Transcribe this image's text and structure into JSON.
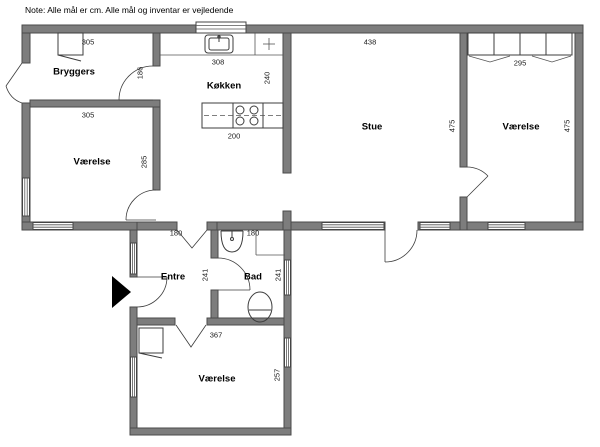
{
  "note": "Note: Alle mål er cm. Alle mål og inventar er vejledende",
  "rooms": {
    "bryggers": {
      "name": "Bryggers",
      "width": "305",
      "height": "186"
    },
    "vaerelse_left": {
      "name": "Værelse",
      "width": "305",
      "height": "285"
    },
    "koekken": {
      "name": "Køkken",
      "width": "308",
      "height": "240",
      "island_width": "200"
    },
    "stue": {
      "name": "Stue",
      "width": "438",
      "height": "475"
    },
    "vaerelse_right": {
      "name": "Værelse",
      "width": "295",
      "height": "475"
    },
    "entre": {
      "name": "Entre",
      "width": "180",
      "height": "241"
    },
    "bad": {
      "name": "Bad",
      "width": "180",
      "height": "241"
    },
    "vaerelse_bottom": {
      "name": "Værelse",
      "width": "367",
      "height": "257"
    }
  },
  "colors": {
    "wall_fill": "#7d7d7d",
    "wall_stroke": "#4a4a4a",
    "line": "#3c3c3c"
  }
}
